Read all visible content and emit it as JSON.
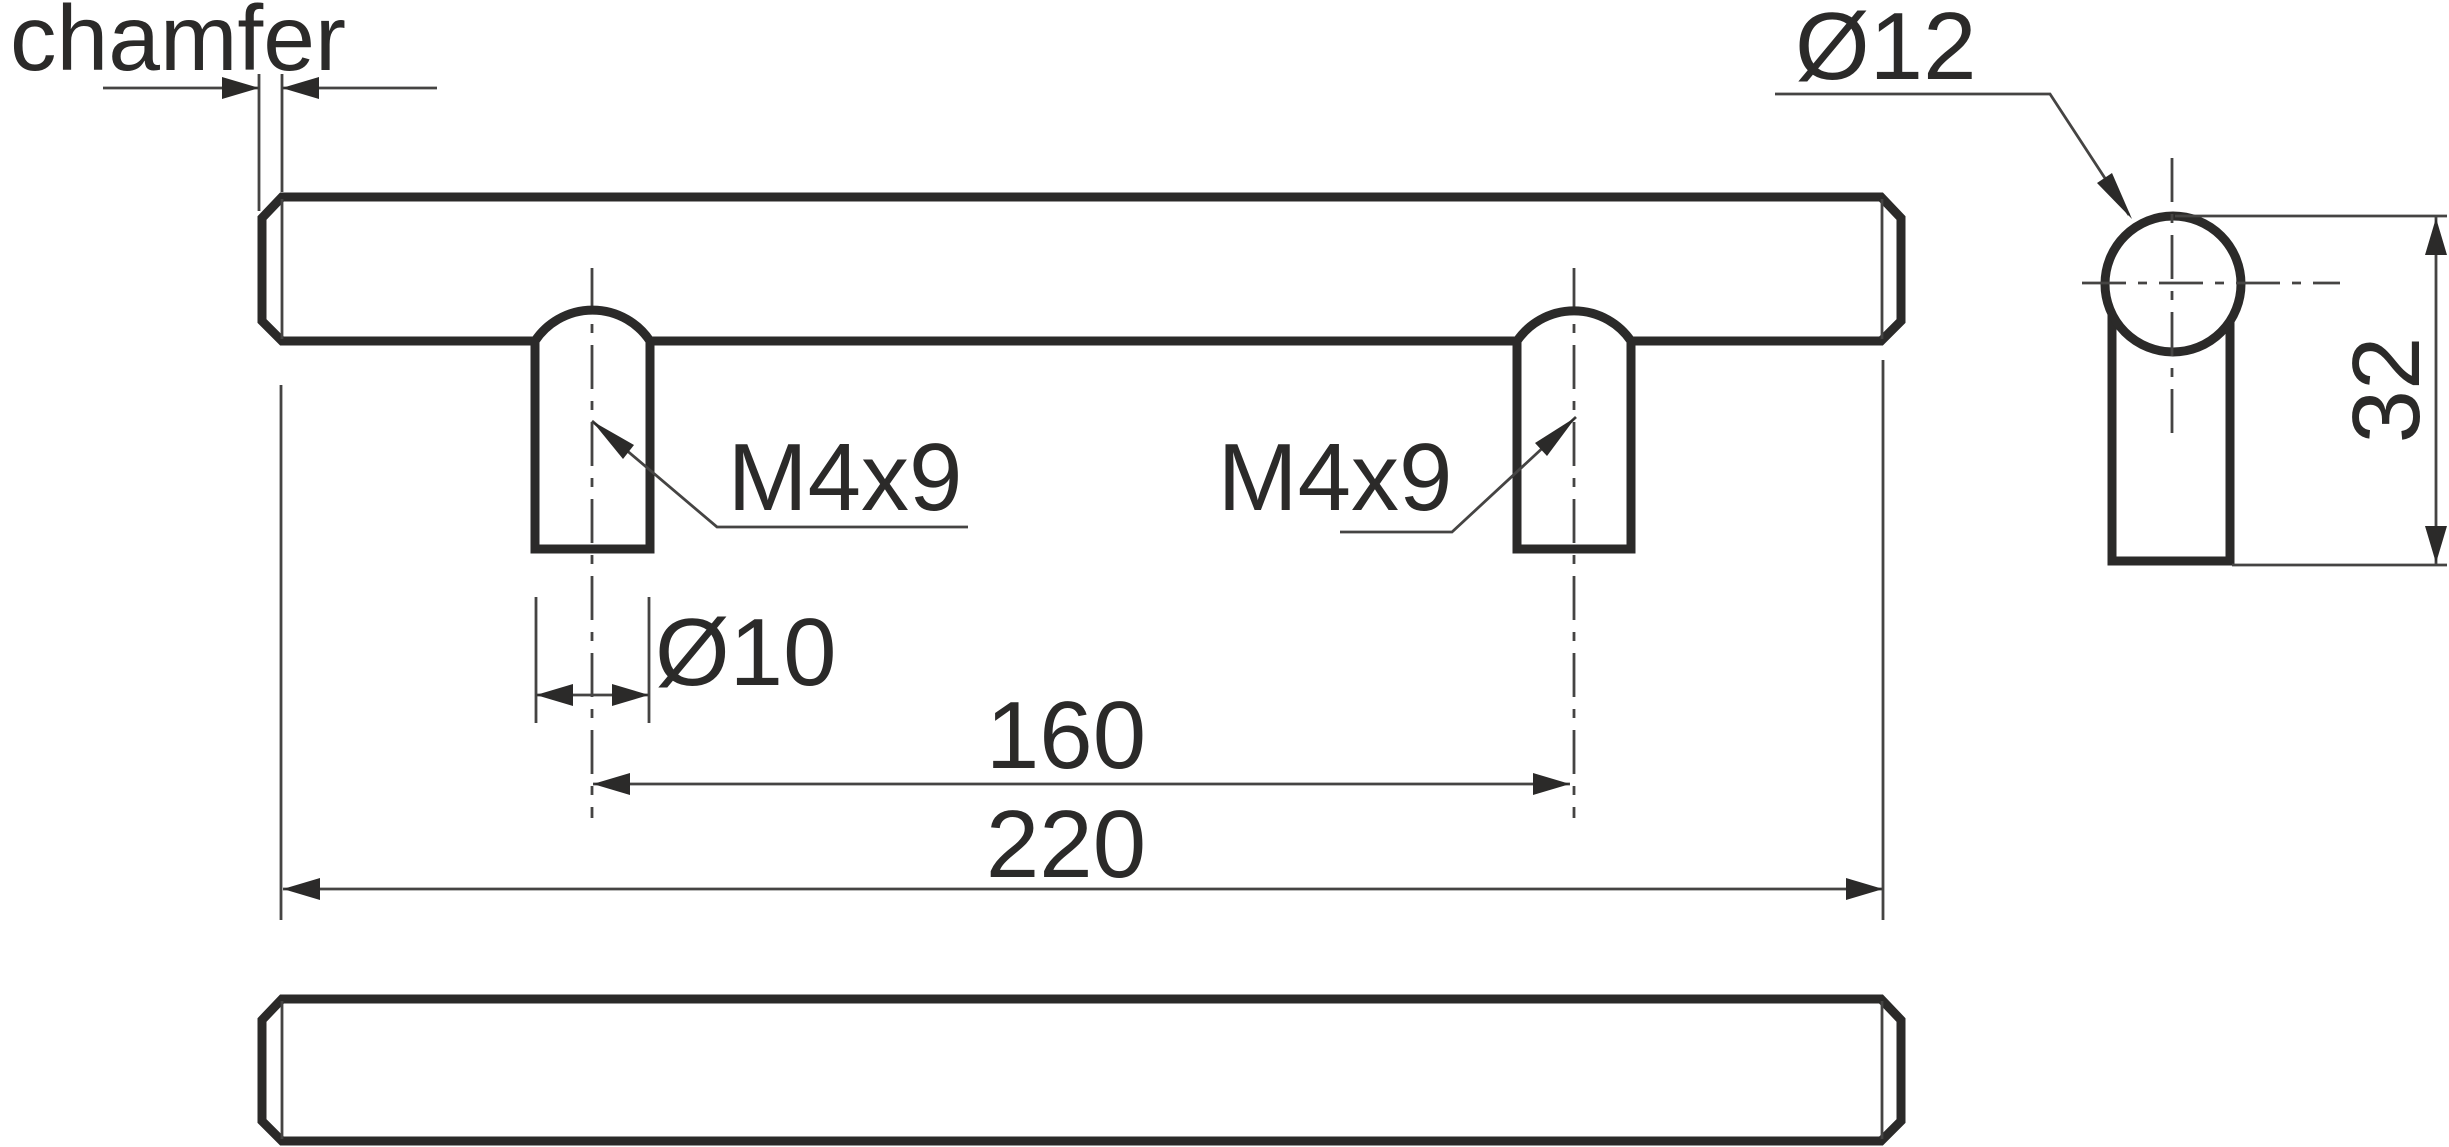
{
  "drawing": {
    "title": "bar handle technical drawing",
    "labels": {
      "chamfer": "chamfer",
      "head_diameter": "Ø12",
      "thread_left": "M4x9",
      "thread_right": "M4x9",
      "post_diameter": "Ø10",
      "hole_spacing": "160",
      "overall_length": "220",
      "side_height": "32"
    },
    "dimensions_mm": {
      "overall_length": 220,
      "hole_spacing": 160,
      "post_diameter": 10,
      "head_diameter": 12,
      "side_height": 32,
      "thread": "M4x9"
    },
    "colors": {
      "background": "#ffffff",
      "outline": "#2b2a29",
      "thin_line": "#454443",
      "text": "#2b2a29"
    }
  }
}
